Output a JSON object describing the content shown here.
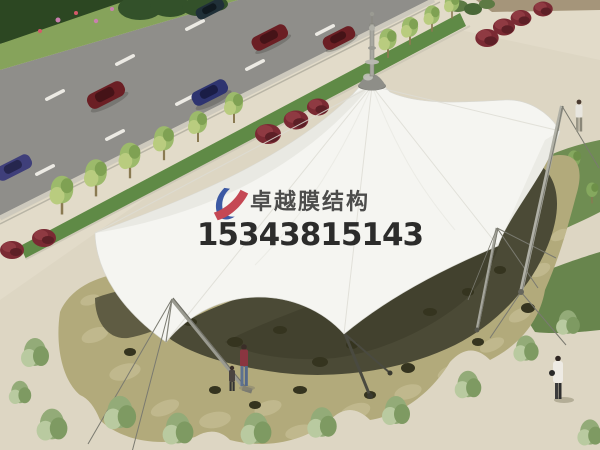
{
  "watermark": {
    "company_name": "卓越膜结构",
    "phone_number": "15343815143",
    "logo": {
      "blue": "#2e4d9e",
      "red": "#c23a47"
    },
    "name_color": "#3e3e3e",
    "phone_color": "#1b1b1b"
  },
  "scene": {
    "type": "architectural-rendering",
    "subject": "white tensile membrane canopy structure over a flagstone plaza beside a road",
    "colors": {
      "ground_sand": "#ddd6c3",
      "road": "#8f8e8a",
      "lane_marking": "#eceae4",
      "curb": "#cdc9bd",
      "hedge": "#2c4722",
      "grass_verge": "#86a35b",
      "green_strip": "#5f8a46",
      "street_tree": "#9cba6b",
      "red_bush": "#7a2a33",
      "membrane_fabric": "#f5f5f1",
      "membrane_shade": "#e6e6e0",
      "mast_steel": "#a8a8a0",
      "plaza_stone": "#b2aa7b",
      "plaza_stone_light": "#c8c197",
      "canopy_shadow": "#4b4a36",
      "shrub": "#93ab78",
      "lawn": "#6f8d52"
    },
    "inventory": {
      "cars": 6,
      "car_colors": [
        "#203038",
        "#6b1f24",
        "#6b1f24",
        "#6b1f24",
        "#2e3470",
        "#3f3f7a"
      ],
      "street_trees": 10,
      "red_bushes": 10,
      "plaza_shrubs": 12,
      "pedestrians": 4,
      "support_masts": 4,
      "canopy_peaks": 1
    }
  }
}
